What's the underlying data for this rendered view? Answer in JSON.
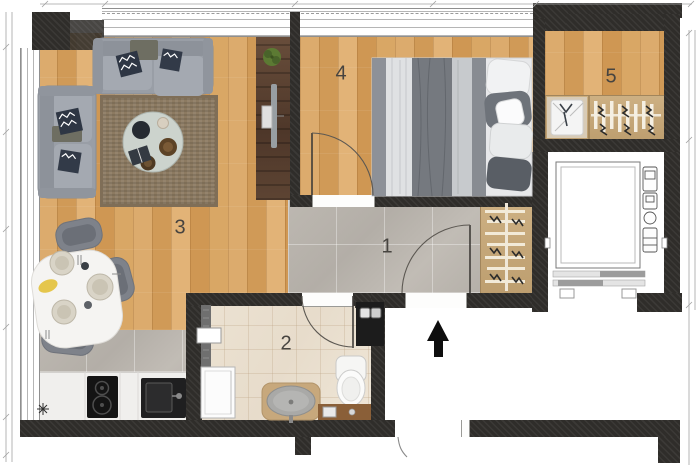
{
  "plan": {
    "rooms": {
      "r1": {
        "label": "1"
      },
      "r2": {
        "label": "2"
      },
      "r3": {
        "label": "3"
      },
      "r4": {
        "label": "4"
      },
      "r5": {
        "label": "5"
      }
    },
    "icons": {
      "north_arrow": "filled-triangle-up-arrow",
      "kitchen_symbol": "eight-point-star"
    },
    "colors": {
      "wall": "#2f2d2a",
      "wood_floor": "#d7a263",
      "gray_tile": "#b7b2ab",
      "bath_tile": "#eadfce",
      "walnut_cabinet": "#5a4534",
      "sofa_gray": "#9aa0a8"
    }
  }
}
